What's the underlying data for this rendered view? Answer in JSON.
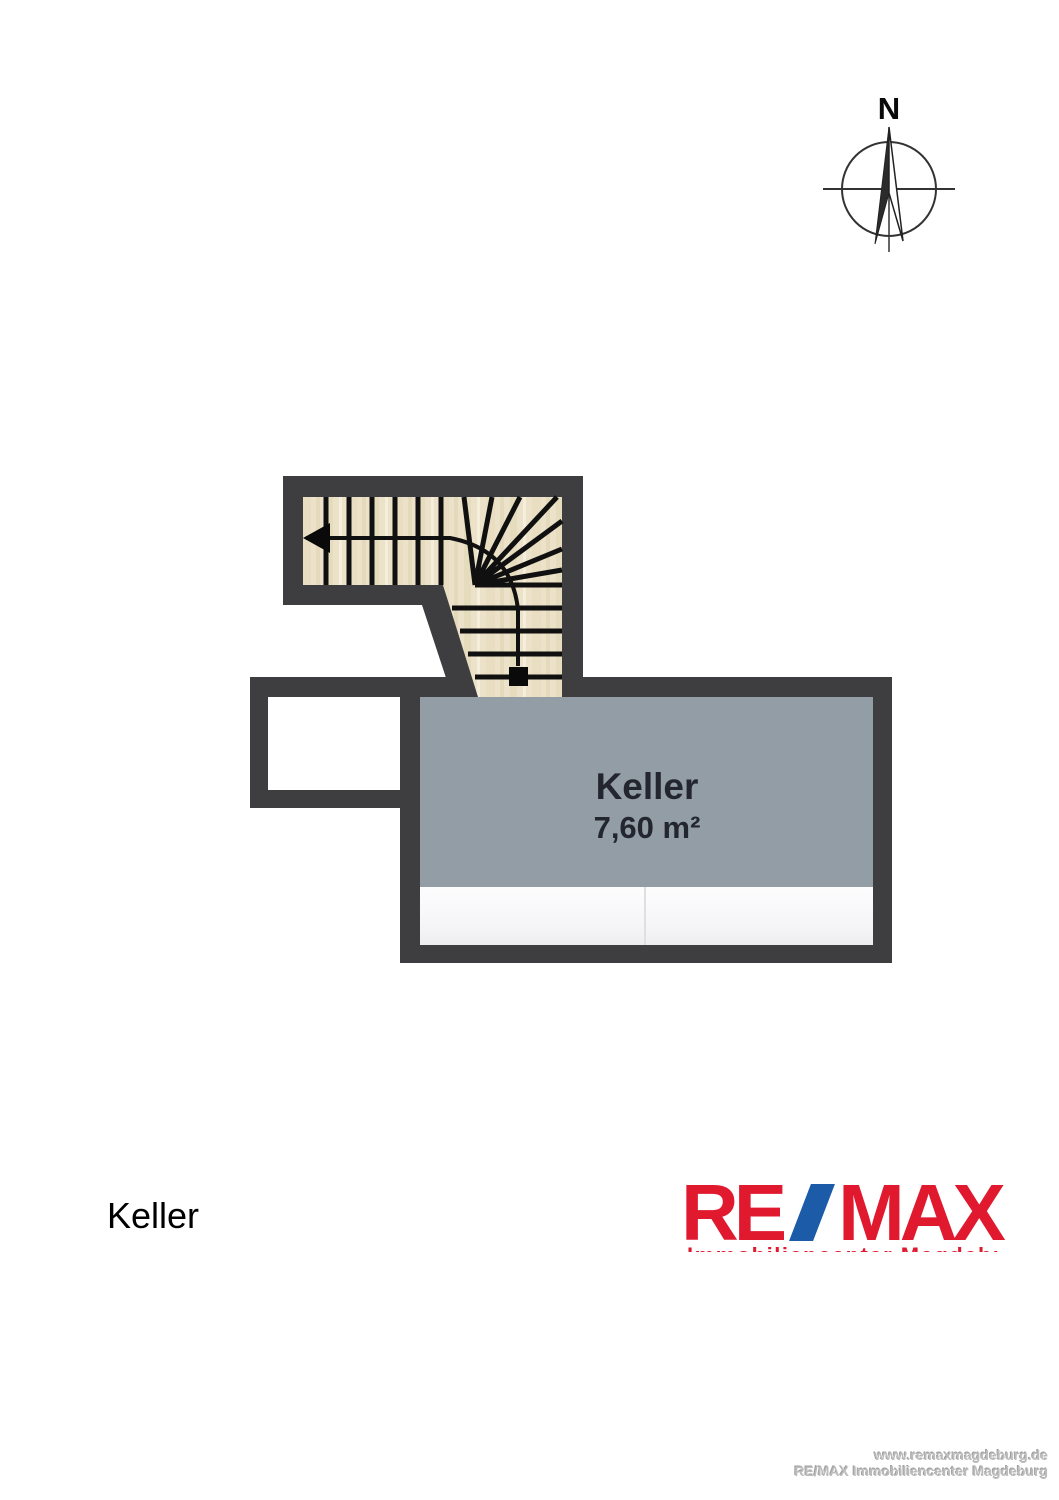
{
  "compass": {
    "north_label": "N"
  },
  "plan": {
    "room_label": "Keller",
    "room_area": "7,60 m²",
    "colors": {
      "wall": "#3e3e40",
      "floor": "#939da6",
      "stairs": "#ece2c9",
      "stair_lines": "#101010",
      "cabinet_divider": "#dfdfe2",
      "label_text": "#23262e"
    }
  },
  "caption": {
    "title": "Keller"
  },
  "logo": {
    "re": "RE",
    "max": "MAX",
    "subline": "Immobiliencenter Magdeburg",
    "red": "#e0192f",
    "blue": "#1b5ba8"
  },
  "footer": {
    "website": "www.remaxmagdeburg.de",
    "office": "RE/MAX Immobiliencenter Magdeburg"
  }
}
